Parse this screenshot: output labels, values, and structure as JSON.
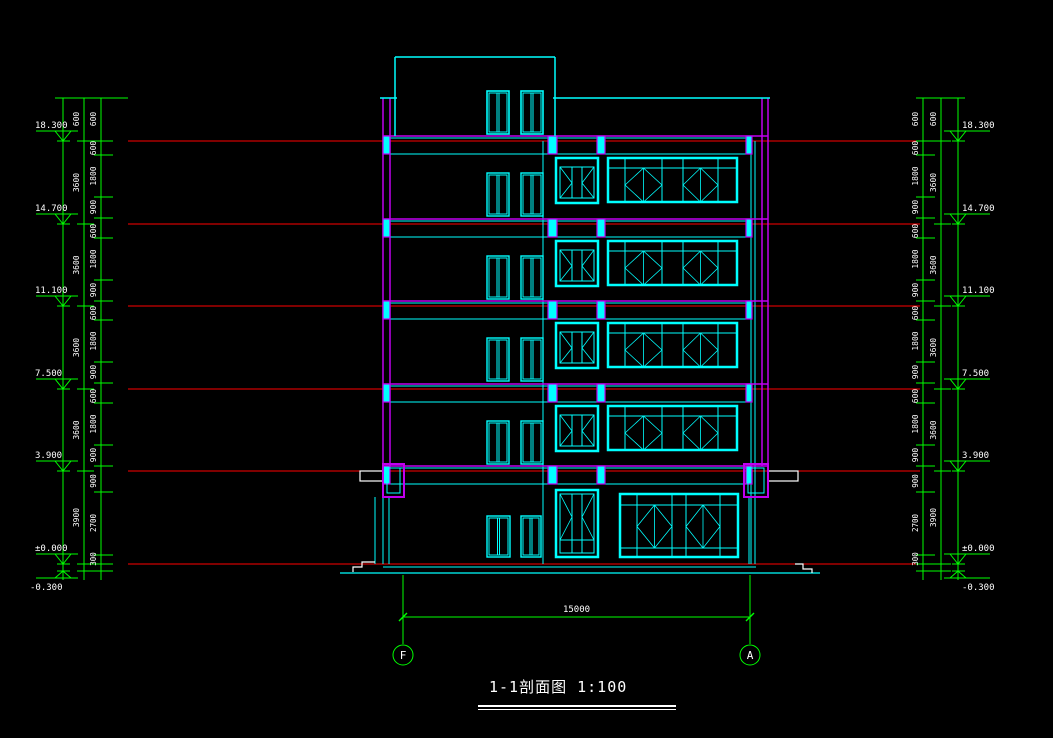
{
  "title": {
    "text": "1-1剖面图 1:100"
  },
  "colors": {
    "bg": "#000000",
    "green": "#00ff00",
    "cyan": "#00ffff",
    "red": "#ff0000",
    "magenta": "#c000f0",
    "white": "#ffffff"
  },
  "elevations": [
    "18.300",
    "14.700",
    "11.100",
    "7.500",
    "3.900",
    "±0.000"
  ],
  "minus_elevation": "-0.300",
  "storey_heights": [
    "600",
    "3600",
    "3600",
    "3600",
    "3600",
    "3900"
  ],
  "floor_detail_dims": [
    "600",
    "1800",
    "900"
  ],
  "ground_detail_dims": [
    "900",
    "2700",
    "300"
  ],
  "top_parapet_dim": "600",
  "bottom_dim": {
    "total": "15000"
  },
  "grid_bubbles": [
    {
      "label": "F"
    },
    {
      "label": "A"
    }
  ],
  "geom": {
    "levels_y": [
      141,
      224,
      306,
      389,
      471,
      564
    ],
    "minus_level_y": 571,
    "chain_top_y": 98,
    "chain_bottom_y": 580,
    "left_cols_x": [
      63,
      84,
      101
    ],
    "right_cols_x": [
      958,
      941,
      923
    ],
    "red_x1": 128,
    "red_x2": 920,
    "typical_floor_ticks": [
      14,
      56,
      77
    ],
    "ground_ticks": [
      492,
      555
    ],
    "building": {
      "left_wall": [
        383,
        390
      ],
      "right_wall": [
        762,
        768
      ],
      "right_inner": [
        751,
        755
      ],
      "interior_cols": [
        [
          548,
          557
        ],
        [
          597,
          605
        ]
      ],
      "wall_blocks": [
        [
          383,
          390
        ],
        [
          548,
          557
        ],
        [
          597,
          605
        ],
        [
          746,
          752
        ]
      ],
      "partition_x": 543,
      "parapet_top_y": 98,
      "penthouse": {
        "x1": 395,
        "x2": 555,
        "top_y": 57
      },
      "beam_x1": 383,
      "beam_x2": 768,
      "slab_y": 567,
      "ground_y": 573
    },
    "grids_x": [
      403,
      750
    ],
    "grid_top_y": 575,
    "grid_bot_y": 644,
    "dim_line_y": 617,
    "bubble_y": 655,
    "bubble_r": 10
  }
}
